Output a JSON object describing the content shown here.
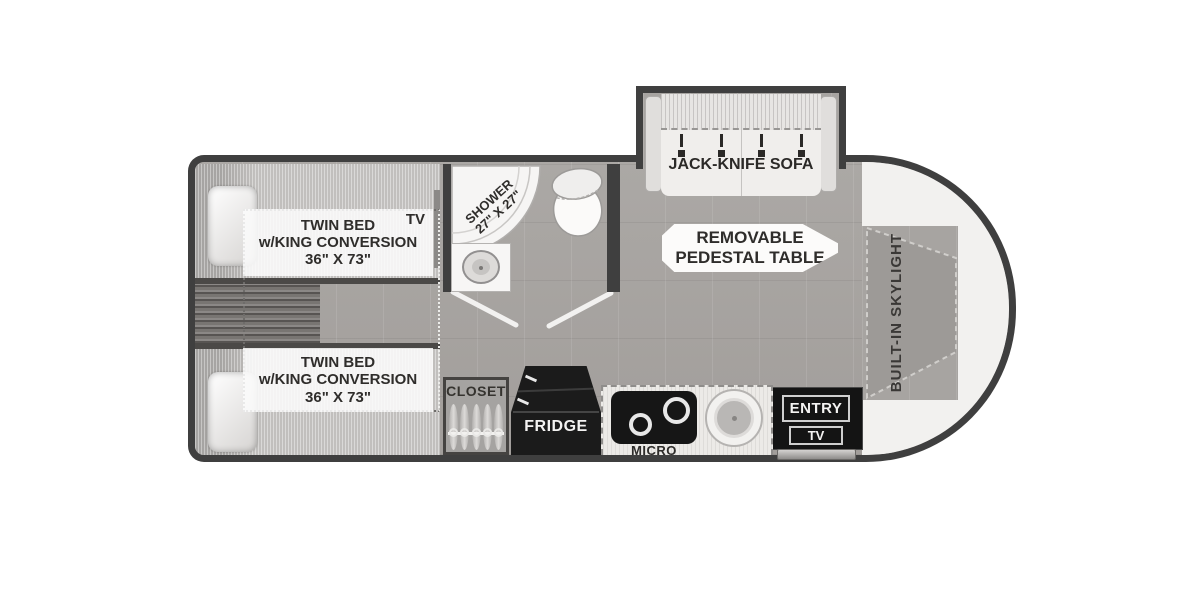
{
  "bedroom": {
    "bed_top": {
      "line1": "TWIN BED",
      "line2": "w/KING CONVERSION",
      "line3": "36\" X 73\""
    },
    "bed_bottom": {
      "line1": "TWIN BED",
      "line2": "w/KING CONVERSION",
      "line3": "36\" X 73\""
    },
    "tv_label": "TV"
  },
  "bathroom": {
    "shower_line1": "SHOWER",
    "shower_line2": "27\" X 27\""
  },
  "living": {
    "sofa_label": "JACK-KNIFE SOFA",
    "table_line1": "REMOVABLE",
    "table_line2": "PEDESTAL TABLE",
    "skylight_label": "BUILT-IN SKYLIGHT"
  },
  "kitchen": {
    "closet_label": "CLOSET",
    "fridge_label": "FRIDGE",
    "micro_label": "MICRO",
    "entry_label": "ENTRY",
    "entry_tv_label": "TV"
  },
  "colors": {
    "wall": "#3f3f3f",
    "floor": "#a7a4a1",
    "appliance_black": "#141414",
    "fixture_white": "#f4f3f2"
  }
}
